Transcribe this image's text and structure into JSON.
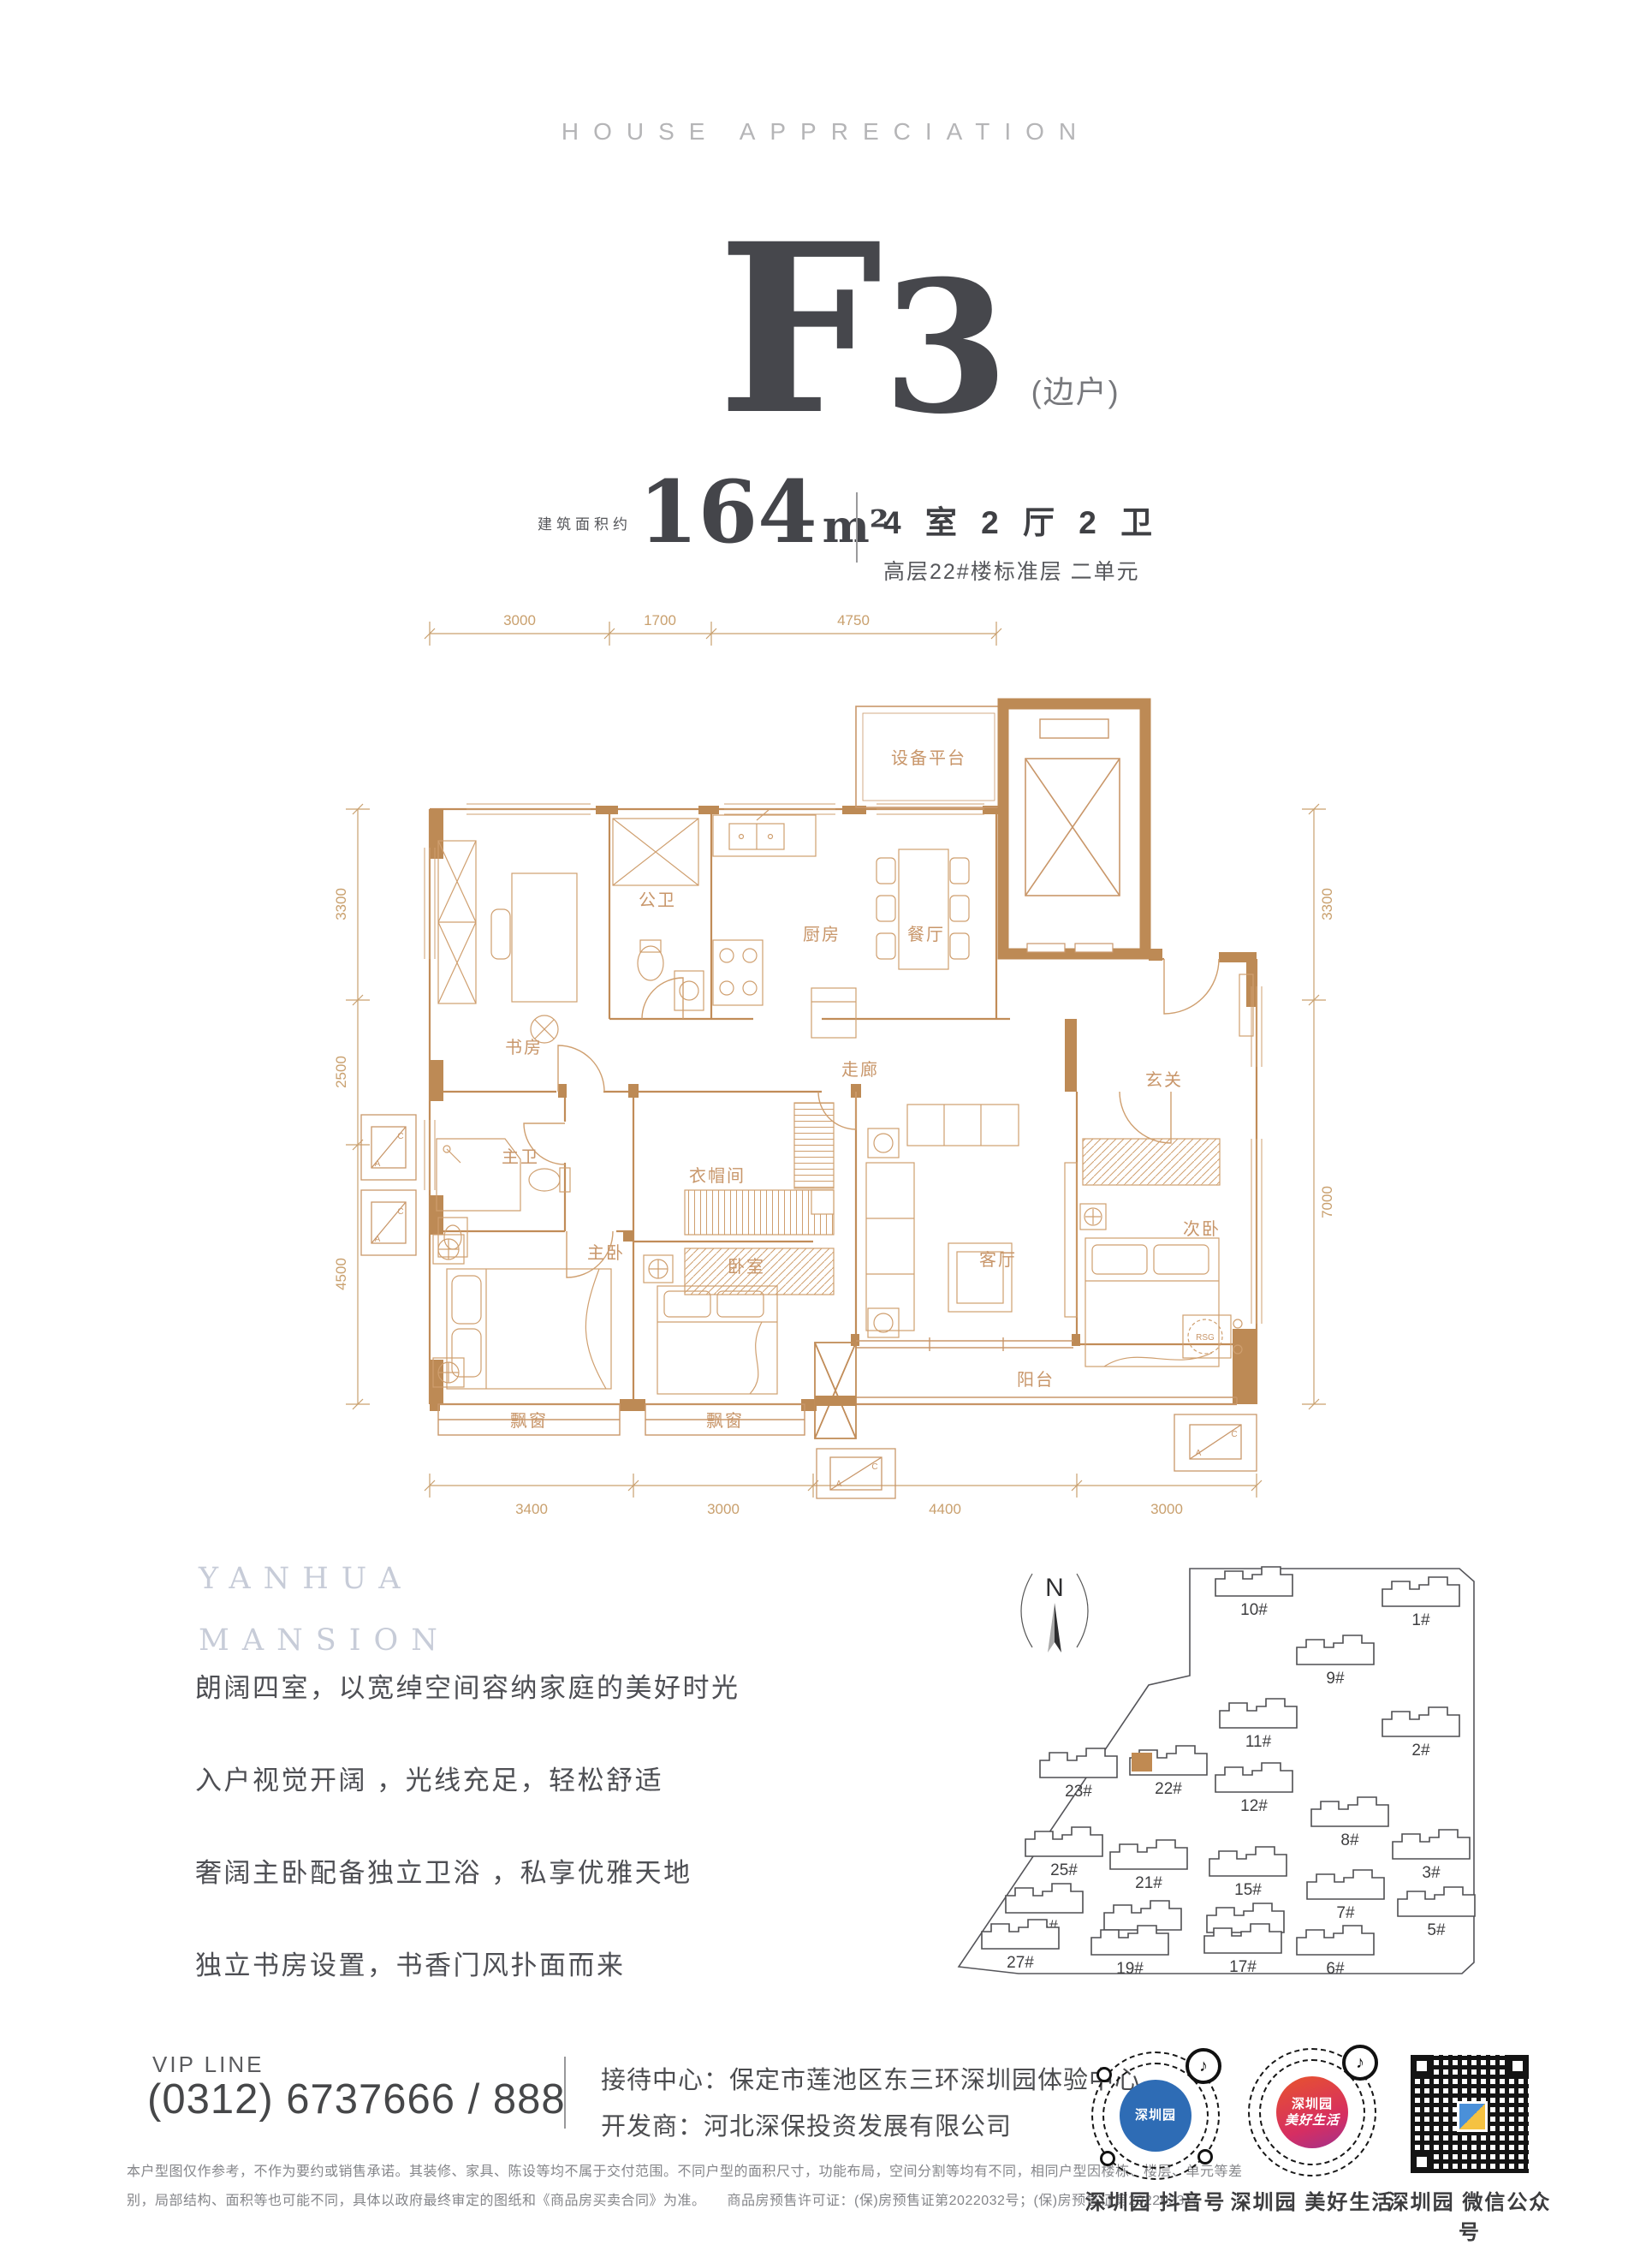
{
  "header": {
    "subtitle": "HOUSE APPRECIATION"
  },
  "unit": {
    "letter": "F",
    "digit": "3",
    "note": "(边户)",
    "area_label": "建筑面积约",
    "area_value": "164",
    "area_unit": "m²",
    "rooms_spec": "4 室 2 厅 2 卫",
    "floor_spec": "高层22#楼标准层 二单元"
  },
  "floor_plan": {
    "dims_top": [
      "3000",
      "1700",
      "4750"
    ],
    "dims_bottom": [
      "3400",
      "3000",
      "4400",
      "3000"
    ],
    "dims_left": [
      "3300",
      "2500",
      "4500"
    ],
    "dims_right": [
      "3300",
      "7000"
    ],
    "rooms": {
      "study": "书房",
      "guest_bath": "公卫",
      "kitchen": "厨房",
      "dining": "餐厅",
      "equipment": "设备平台",
      "corridor": "走廊",
      "foyer": "玄关",
      "master_bath": "主卫",
      "cloakroom": "衣帽间",
      "master_bedroom": "主卧",
      "bedroom": "卧室",
      "living": "客厅",
      "second_bedroom": "次卧",
      "bay_window_1": "飘窗",
      "bay_window_2": "飘窗",
      "balcony": "阳台",
      "rsg": "RSG"
    },
    "ac": {
      "a": "A",
      "c": "C"
    }
  },
  "brand": {
    "line1": "YANHUA",
    "line2": "MANSION"
  },
  "description": {
    "lines": [
      "朗阔四室，以宽绰空间容纳家庭的美好时光",
      "入户视觉开阔 ，光线充足，轻松舒适",
      "奢阔主卧配备独立卫浴 ，私享优雅天地",
      "独立书房设置，书香门风扑面而来"
    ]
  },
  "site_map": {
    "north_label": "N",
    "buildings": [
      {
        "label": "10#"
      },
      {
        "label": "1#"
      },
      {
        "label": "9#"
      },
      {
        "label": "11#"
      },
      {
        "label": "2#"
      },
      {
        "label": "23#"
      },
      {
        "label": "22#"
      },
      {
        "label": "12#"
      },
      {
        "label": "8#"
      },
      {
        "label": "25#"
      },
      {
        "label": "21#"
      },
      {
        "label": "15#"
      },
      {
        "label": "3#"
      },
      {
        "label": "26#"
      },
      {
        "label": "7#"
      },
      {
        "label": "20#"
      },
      {
        "label": "16#"
      },
      {
        "label": "5#"
      },
      {
        "label": "27#"
      },
      {
        "label": "19#"
      },
      {
        "label": "17#"
      },
      {
        "label": "6#"
      }
    ]
  },
  "footer": {
    "vip_label": "VIP LINE",
    "phone": "(0312)  6737666 / 888",
    "reception": "接待中心：保定市莲池区东三环深圳园体验中心",
    "developer": "开发商：河北深保投资发展有限公司",
    "disclaimer1": "本户型图仅作参考，不作为要约或销售承诺。其装修、家具、陈设等均不属于交付范围。不同户型的面积尺寸，功能布局，空间分割等均有不同，相同户型因楼栋、楼层、单元等差",
    "disclaimer2": "别，局部结构、面积等也可能不同，具体以政府最终审定的图纸和《商品房买卖合同》为准。　　商品房预售许可证：(保)房预售证第2022032号；(保)房预售证第2022033号",
    "qr": [
      {
        "label": "深圳园 抖音号",
        "core": "深圳园"
      },
      {
        "label": "深圳园 美好生活",
        "core": "深圳园",
        "core2": "美好生活"
      },
      {
        "label": "深圳园 微信公众号"
      }
    ]
  },
  "icons": {
    "music_note": "♪"
  }
}
